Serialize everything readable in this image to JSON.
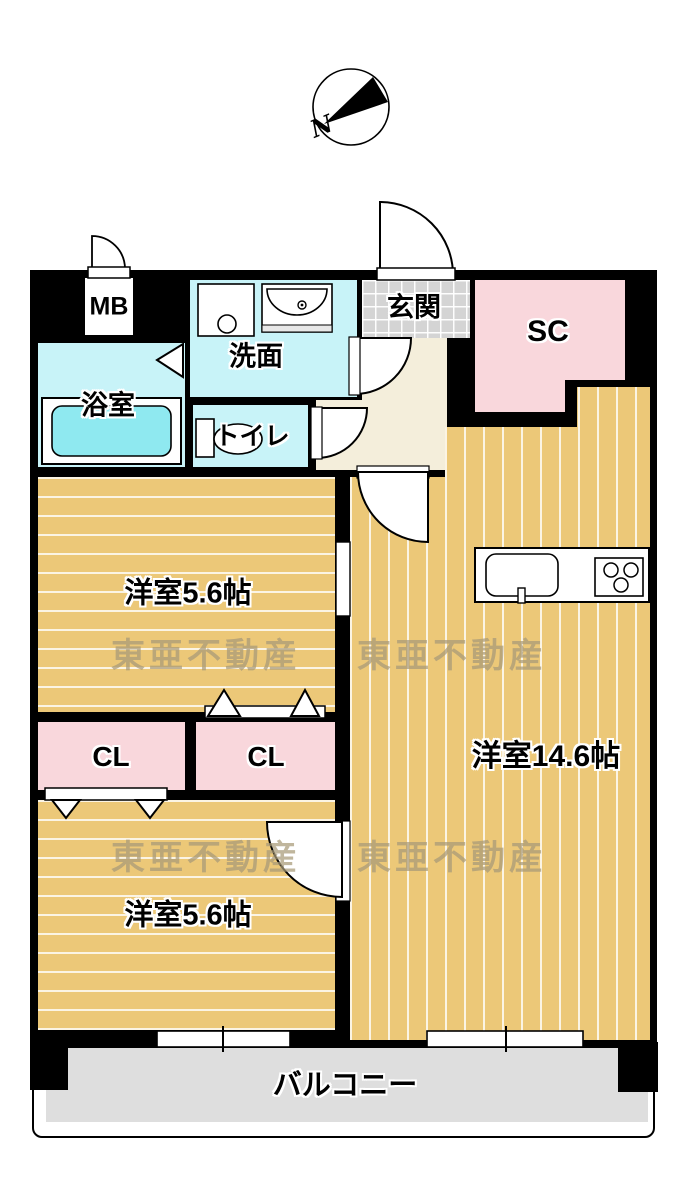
{
  "compass": {
    "north_label": "N"
  },
  "watermark": {
    "text": "東亜不動産"
  },
  "rooms": {
    "mb": "MB",
    "washroom": "洗面",
    "entrance": "玄関",
    "shoe_closet": "SC",
    "bathroom": "浴室",
    "toilet": "トイレ",
    "bedroom_upper": "洋室5.6帖",
    "bedroom_lower": "洋室5.6帖",
    "living_room": "洋室14.6帖",
    "closet_left": "CL",
    "closet_right": "CL",
    "balcony": "バルコニー"
  },
  "colors": {
    "wall": "#000000",
    "wet_area_cyan": "#c8f3f8",
    "bathtub_cyan": "#8fe9f0",
    "closet_pink": "#f9d7dc",
    "flooring_tan": "#ecc878",
    "hallway_cream": "#f4eedb",
    "entrance_tile_gray": "#d4d4d4",
    "balcony_gray": "#dedede",
    "watermark_color": "#a89a78"
  }
}
